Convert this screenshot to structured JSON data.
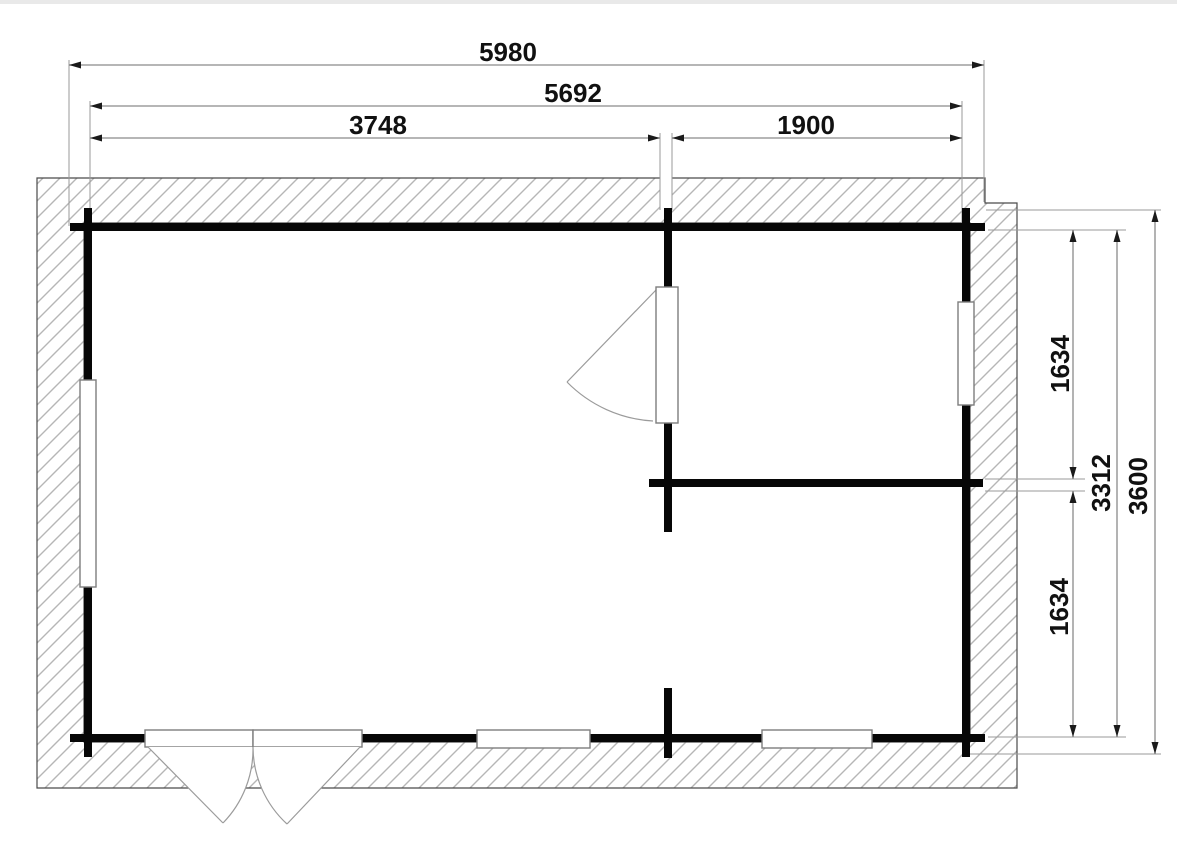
{
  "drawing": {
    "type": "floor-plan",
    "units": "mm",
    "dims": {
      "overall_width": "5980",
      "outer_wall_width": "5692",
      "left_room_width": "3748",
      "right_room_width": "1900",
      "right_room_depth_upper": "1634",
      "inner_depth": "3312",
      "overall_depth": "3600",
      "right_room_depth_lower": "1634"
    },
    "colors": {
      "wall": "#070707",
      "dimension_line": "#8a8a8a",
      "extension_line": "#9a9a9a",
      "hatch_line": "#b6b6b6",
      "outline": "#4a4a4a",
      "label": "#111111",
      "background": "#ffffff"
    }
  }
}
